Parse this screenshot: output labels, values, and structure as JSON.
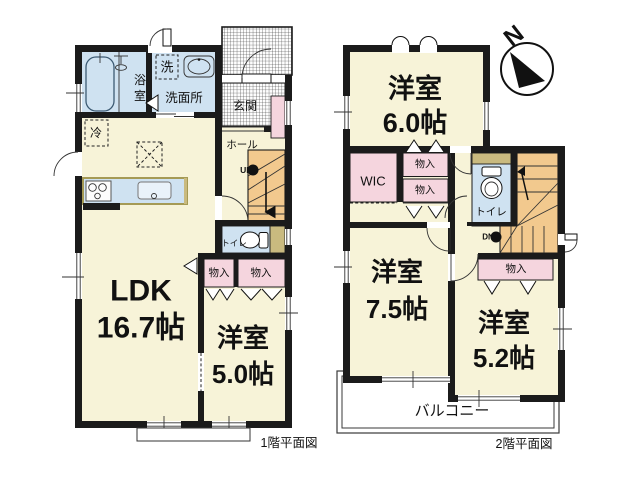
{
  "colors": {
    "wall": "#1b1b1b",
    "room_cream": "#f7f3d8",
    "wet_area_blue": "#cfe2f1",
    "storage_pink": "#f5d5de",
    "stairs_orange": "#f2c98e",
    "counter_tan": "#c9ba7f"
  },
  "compass": {
    "north_label": "N"
  },
  "floor1": {
    "caption": "1階平面図",
    "ldk": {
      "name": "LDK",
      "size": "16.7帖"
    },
    "bedroom": {
      "name": "洋室",
      "size": "5.0帖"
    },
    "bath_char_top": "浴",
    "bath_char_bottom": "室",
    "laundry": "洗",
    "washroom": "洗面所",
    "entrance": "玄関",
    "hall": "ホール",
    "stairs_up": "UP",
    "toilet": "トイレ",
    "storage_left": "物入",
    "storage_right": "物入",
    "fridge": "冷"
  },
  "floor2": {
    "caption": "2階平面図",
    "bedroom_6": {
      "name": "洋室",
      "size": "6.0帖"
    },
    "bedroom_75": {
      "name": "洋室",
      "size": "7.5帖"
    },
    "bedroom_52": {
      "name": "洋室",
      "size": "5.2帖"
    },
    "wic": "WIC",
    "storage_top": "物入",
    "storage_middle": "物入",
    "storage_lower": "物入",
    "toilet": "トイレ",
    "stairs_down": "DN",
    "balcony": "バルコニー"
  }
}
